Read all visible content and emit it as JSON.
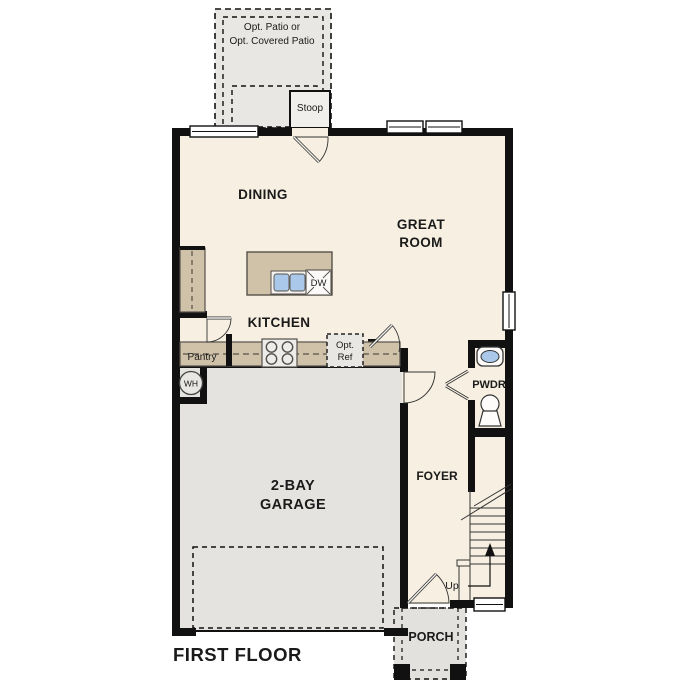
{
  "title": "FIRST FLOOR",
  "labels": {
    "patio_line1": "Opt. Patio or",
    "patio_line2": "Opt. Covered Patio",
    "stoop": "Stoop",
    "dining": "DINING",
    "great1": "GREAT",
    "great2": "ROOM",
    "kitchen": "KITCHEN",
    "pantry": "Pantry",
    "dw": "DW",
    "opt_ref1": "Opt.",
    "opt_ref2": "Ref",
    "wh": "WH",
    "pwdr": "PWDR",
    "foyer": "FOYER",
    "garage1": "2-BAY",
    "garage2": "GARAGE",
    "up": "Up",
    "porch": "PORCH"
  },
  "colors": {
    "wall": "#111111",
    "interior": "#f7f0e2",
    "garage": "#e4e3e0",
    "patio": "#e9e7e4",
    "porch": "#e3e1de",
    "counter": "#cfc2a9",
    "counter_edge": "#55504a",
    "sink_blue": "#aac8ea"
  }
}
